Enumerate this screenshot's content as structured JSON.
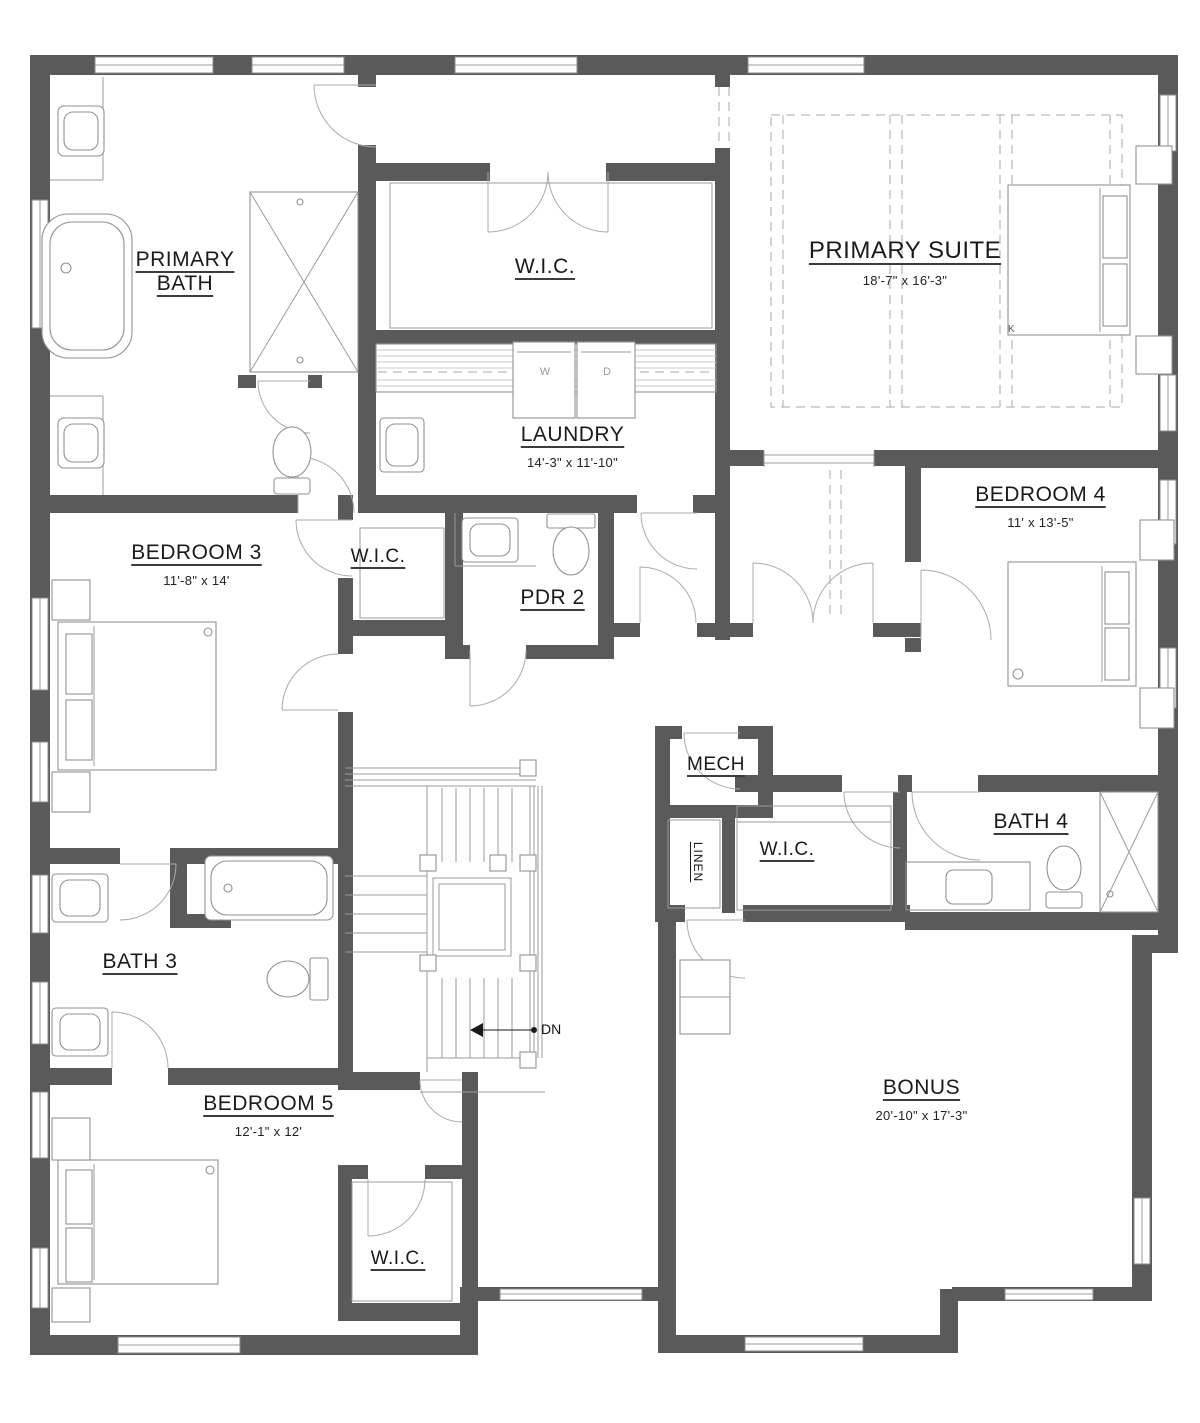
{
  "rooms": [
    {
      "name": "PRIMARY BATH",
      "dims": ""
    },
    {
      "name": "W.I.C.",
      "dims": ""
    },
    {
      "name": "PRIMARY SUITE",
      "dims": "18'-7\" x 16'-3\""
    },
    {
      "name": "LAUNDRY",
      "dims": "14'-3\" x 11'-10\""
    },
    {
      "name": "BEDROOM 4",
      "dims": "11' x 13'-5\""
    },
    {
      "name": "BEDROOM 3",
      "dims": "11'-8\" x 14'"
    },
    {
      "name": "W.I.C.",
      "dims": ""
    },
    {
      "name": "PDR 2",
      "dims": ""
    },
    {
      "name": "MECH",
      "dims": ""
    },
    {
      "name": "LINEN",
      "dims": ""
    },
    {
      "name": "W.I.C.",
      "dims": ""
    },
    {
      "name": "BATH 4",
      "dims": ""
    },
    {
      "name": "BATH 3",
      "dims": ""
    },
    {
      "name": "BEDROOM 5",
      "dims": "12'-1\" x 12'"
    },
    {
      "name": "W.I.C.",
      "dims": ""
    },
    {
      "name": "BONUS",
      "dims": "20'-10\" x 17'-3\""
    }
  ],
  "annotations": {
    "stairs_direction": "DN",
    "washer": "W",
    "dryer": "D",
    "bed_size": "K"
  },
  "colors": {
    "wall": "#5a5a5a",
    "thin_line": "#9b9b9b",
    "text": "#1a1a1a",
    "background": "#ffffff"
  }
}
